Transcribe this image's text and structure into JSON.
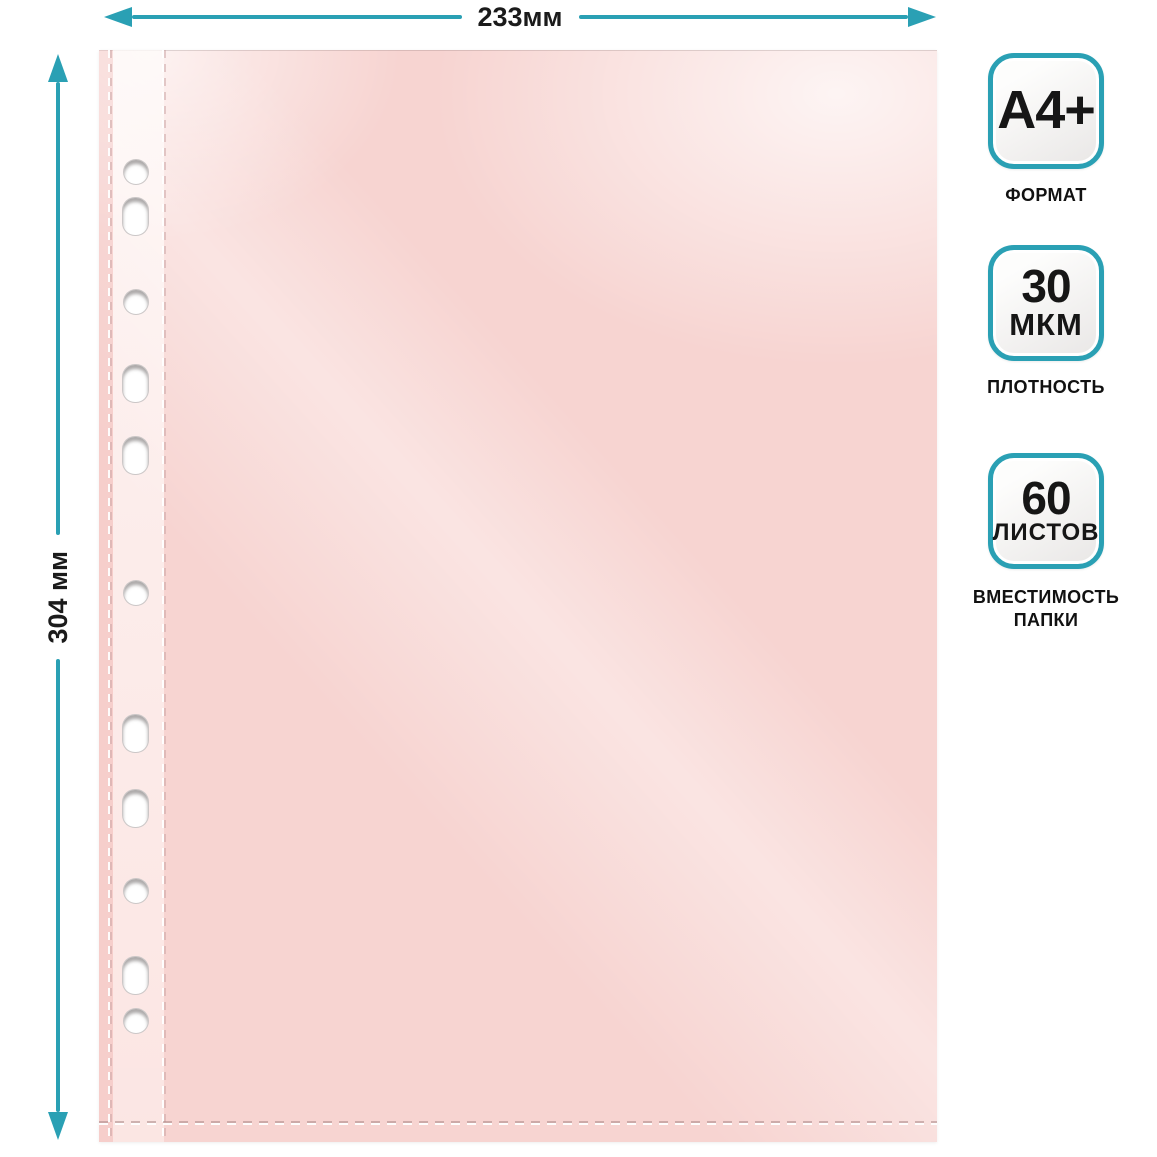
{
  "dimensions": {
    "width_label": "233мм",
    "height_label": "304 мм"
  },
  "badges": [
    {
      "line1": "A4+",
      "line2": "",
      "caption": "ФОРМАТ"
    },
    {
      "line1": "30",
      "line2": "МКМ",
      "caption": "ПЛОТНОСТЬ"
    },
    {
      "line1": "60",
      "line2": "ЛИСТОВ",
      "caption": "ВМЕСТИМОСТЬ\nПАПКИ"
    }
  ],
  "colors": {
    "accent_teal": "#2aa0b4",
    "sheet_pink": "#f7d4d1",
    "label_black": "#1b1b1b"
  }
}
